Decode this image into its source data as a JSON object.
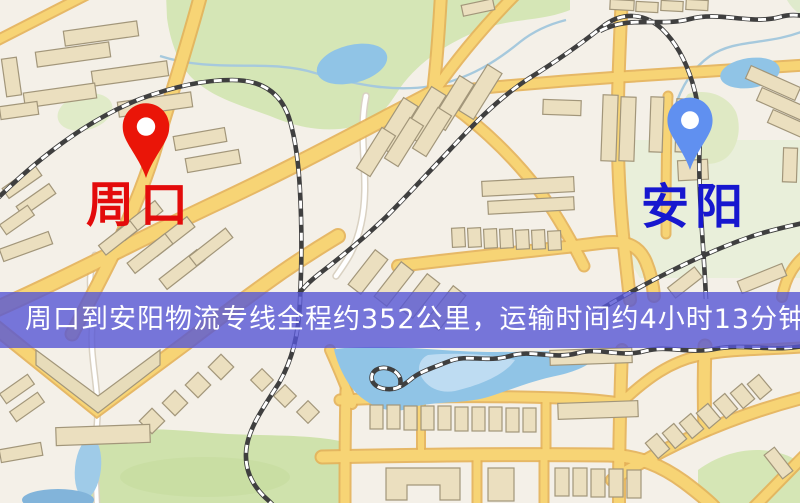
{
  "map": {
    "origin": {
      "label": "周口",
      "label_color": "#e30b0b",
      "pin_color": "#ea1508",
      "pin_icon": "red-map-pin-icon"
    },
    "destination": {
      "label": "安阳",
      "label_color": "#1717cf",
      "pin_color": "#6090f0",
      "pin_icon": "blue-map-pin-icon"
    }
  },
  "banner": {
    "text": "周口到安阳物流专线全程约352公里，运输时间约4小时13分钟.",
    "background_color": "#5656d5",
    "text_color": "#ffffff"
  },
  "route": {
    "origin": "周口",
    "destination": "安阳",
    "distance_text": "约352公里",
    "duration_text": "约4小时13分钟"
  }
}
